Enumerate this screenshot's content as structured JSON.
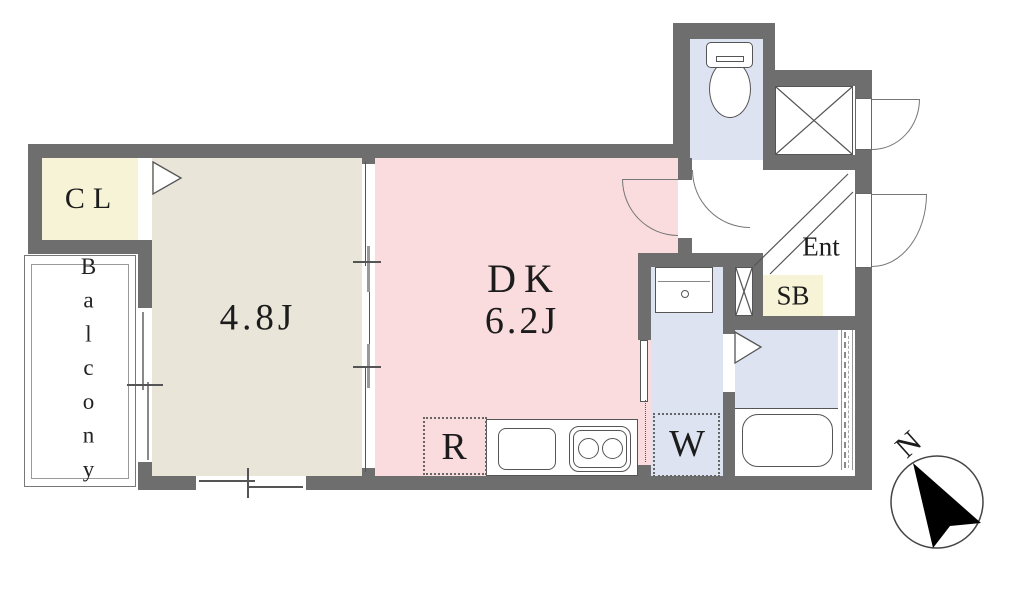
{
  "labels": {
    "closet": "CL",
    "main_room_size": "4.8J",
    "dk_name": "DK",
    "dk_size": "6.2J",
    "balcony": "Balcony",
    "refrigerator_space": "R",
    "washer_space": "W",
    "shoe_box": "SB",
    "entrance": "Ent",
    "compass_north": "N"
  },
  "colors": {
    "wall": "#6e6e6e",
    "main_room_floor": "#eae5d9",
    "dk_floor": "#fbdcde",
    "wet_area_floor": "#dde3f1",
    "storage_fill": "#f6f3d7",
    "thin_line": "#555555",
    "compass_arrow": "#000000"
  }
}
